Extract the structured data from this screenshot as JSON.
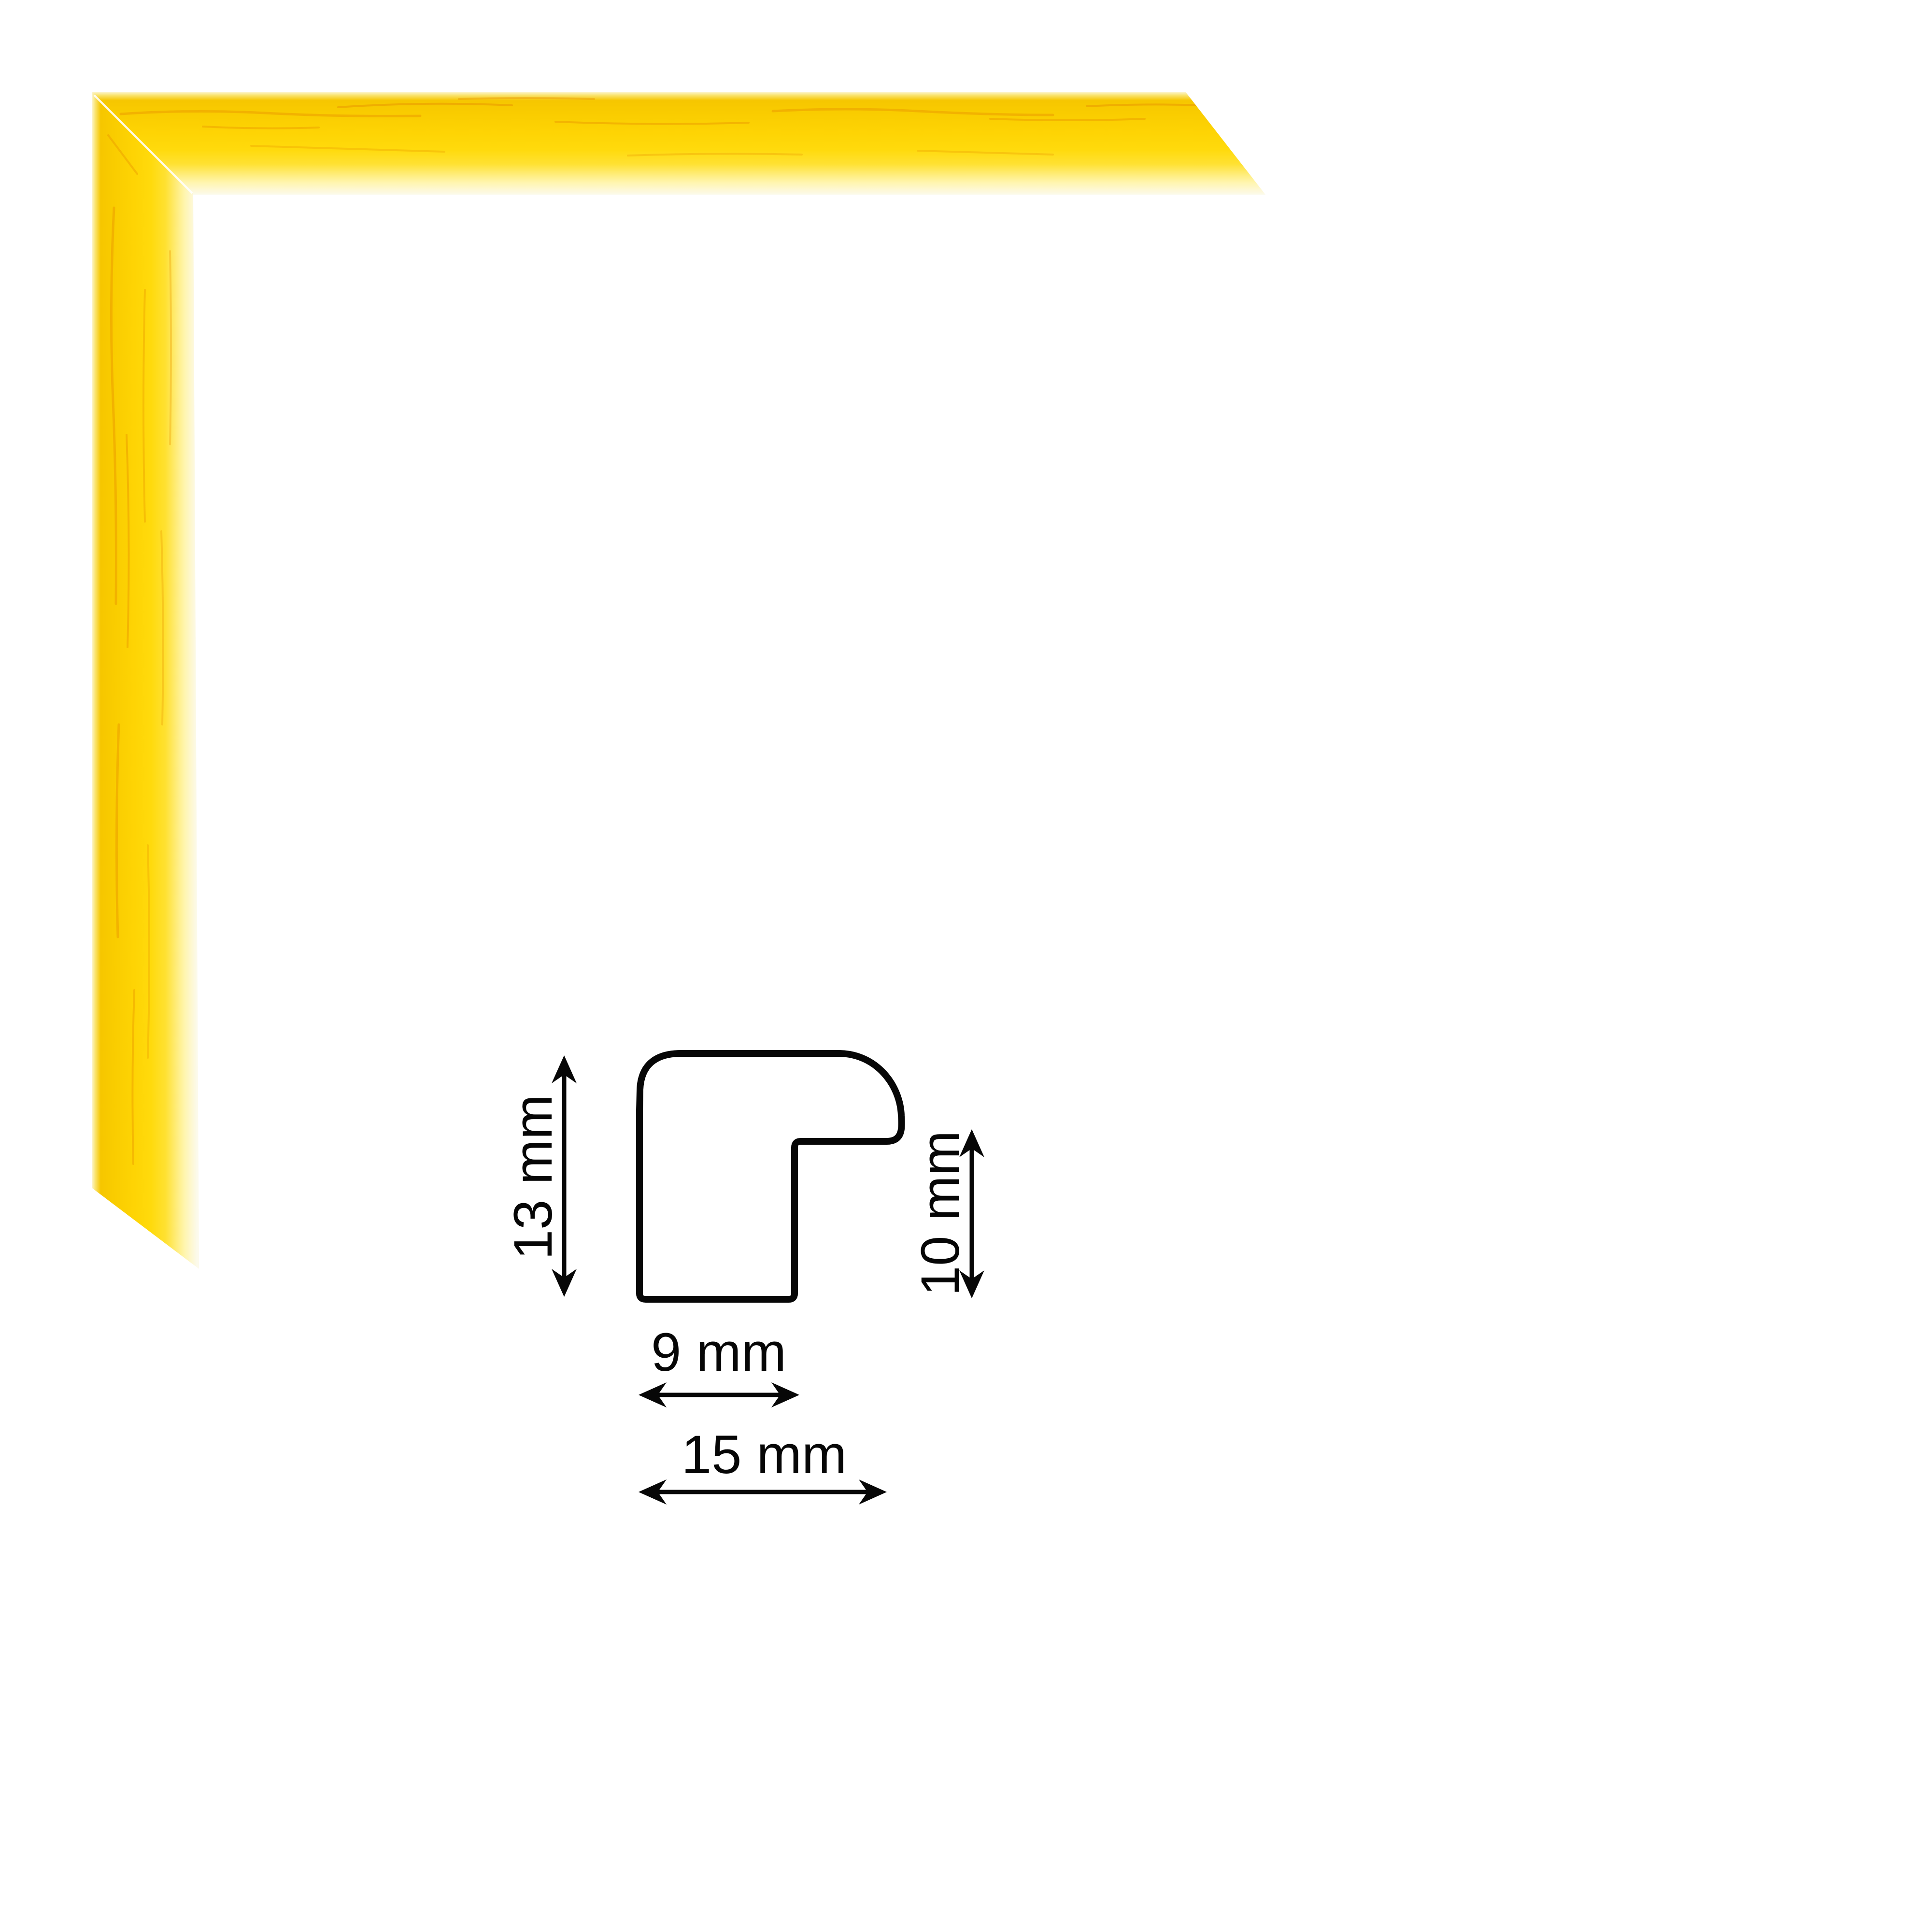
{
  "page": {
    "background_color": "#FFFFFF",
    "description": "Corner sample of a yellow wooden picture-frame moulding with a technical cross-section drawing showing its dimensions"
  },
  "frame_sample": {
    "material_look": "yellow painted wood with orange grain streaks",
    "main_color": "#FFD606",
    "amber_shade_color": "#F6C600",
    "highlight_color": "#FFF6AE",
    "grain_color": "#E89200",
    "miter_seam_color": "#FFFFFF"
  },
  "profile": {
    "outline_color": "#070707",
    "fill_color": "#FFFFFF",
    "dims": {
      "height": "13 mm",
      "rebate": "10 mm",
      "face": "9 mm",
      "width": "15 mm"
    },
    "dims_numeric": {
      "height_mm": 13,
      "rebate_mm": 10,
      "face_mm": 9,
      "width_mm": 15
    }
  }
}
